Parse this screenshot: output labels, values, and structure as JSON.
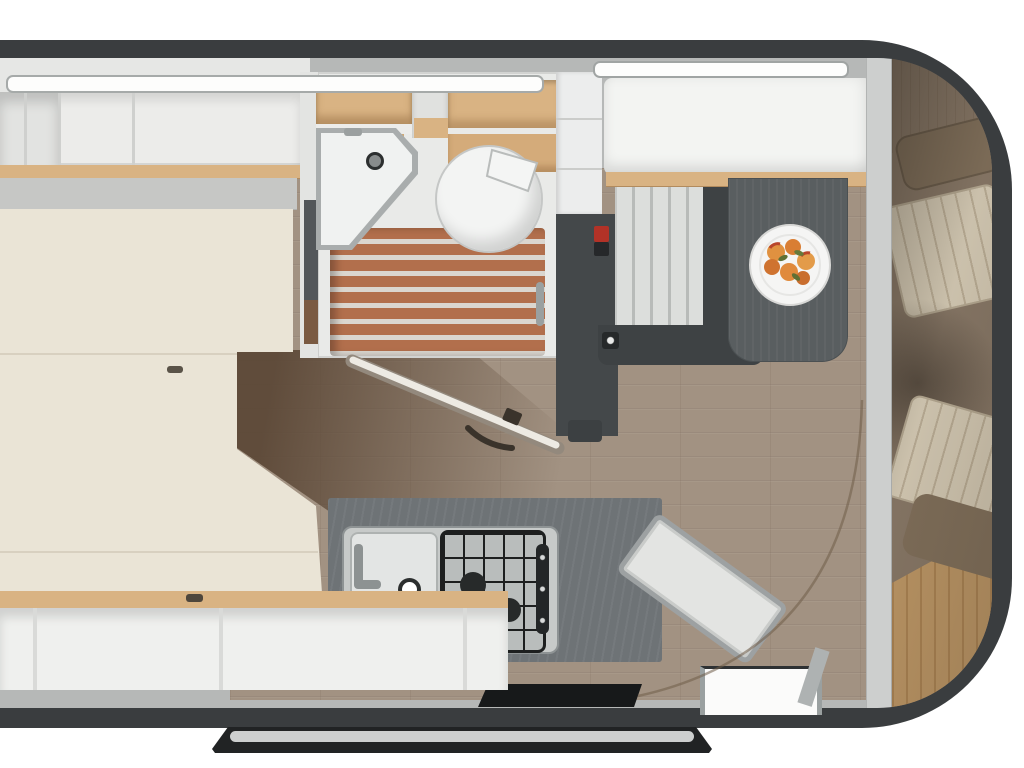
{
  "meta": {
    "type": "motorhome-floorplan-3d-render",
    "view": "top-down",
    "visible_text": []
  },
  "palette": {
    "body_dark": "#3a3d3f",
    "interior_gray": "#b6b8b7",
    "wall_white": "#ececea",
    "bed_cream": "#eae4d6",
    "wood_trim": "#d9b383",
    "floor_oak": "#a29282",
    "floor_walnut": "#5c4837",
    "shower_wood": "#b26f4c",
    "slat_light": "#dbd6cf",
    "counter_dark": "#6e7376",
    "table_dark": "#595e60",
    "cab_taupe": "#8f7e6c",
    "cab_wood": "#c9a06b",
    "seat_cream": "#e2d7c0",
    "accent_red": "#b23227",
    "steel": "#c7cac9"
  },
  "regions": [
    "rear-bed",
    "overhead-lockers",
    "ceiling-lights",
    "washroom",
    "shower-floor",
    "washbasin",
    "toilet",
    "wardrobe",
    "heater-indicator",
    "bench-seat",
    "dining-table",
    "fruit-plate",
    "kitchen-counter",
    "kitchen-sink",
    "gas-hob",
    "entry-step",
    "entry-door-opening",
    "door-sill",
    "cab-partition",
    "cab-seat-front",
    "cab-seat-rear",
    "cab-wood-floor",
    "exterior-step-bar",
    "open-bathroom-door",
    "floor-arc-seam",
    "lower-shelves"
  ]
}
